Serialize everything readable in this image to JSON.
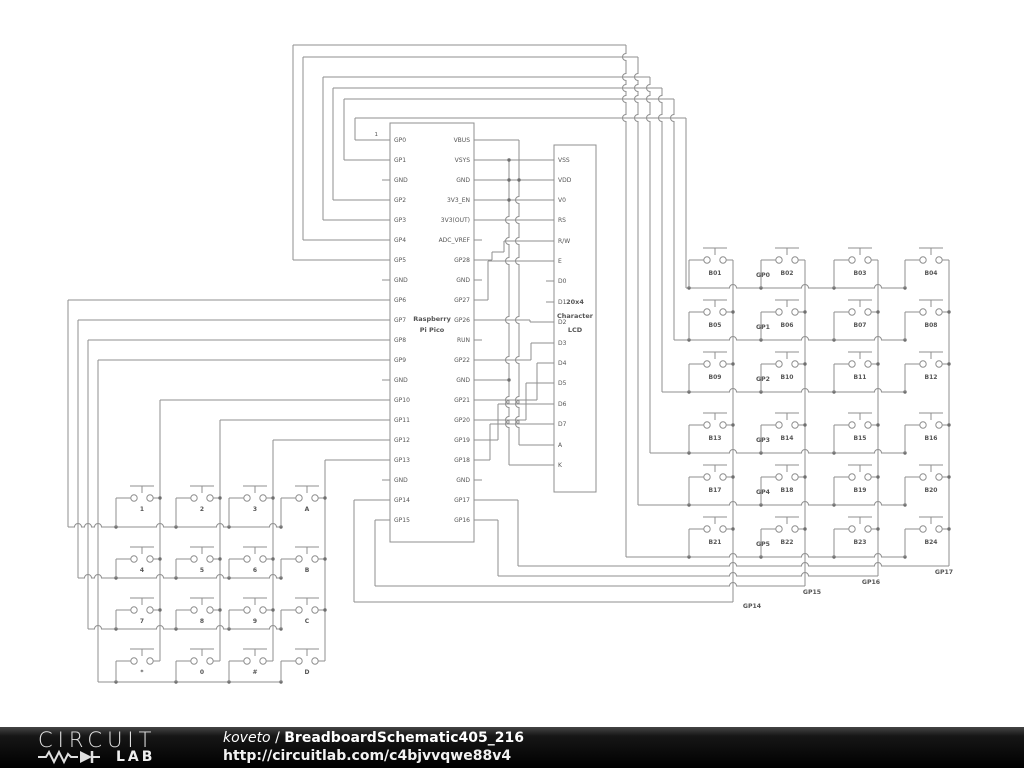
{
  "colors": {
    "wire": "#8f8f8f",
    "text": "#555555",
    "junction": "#6f6f6f",
    "footer_bg": "#0d0d0d",
    "footer_text": "#ffffff"
  },
  "pico": {
    "name_line1": "Raspberry",
    "name_line2": "Pi Pico",
    "pin1_label": "1",
    "left_pins": [
      "GP0",
      "GP1",
      "GND",
      "GP2",
      "GP3",
      "GP4",
      "GP5",
      "GND",
      "GP6",
      "GP7",
      "GP8",
      "GP9",
      "GND",
      "GP10",
      "GP11",
      "GP12",
      "GP13",
      "GND",
      "GP14",
      "GP15"
    ],
    "right_pins": [
      "VBUS",
      "VSYS",
      "GND",
      "3V3_EN",
      "3V3(OUT)",
      "ADC_VREF",
      "GP28",
      "GND",
      "GP27",
      "GP26",
      "RUN",
      "GP22",
      "GND",
      "GP21",
      "GP20",
      "GP19",
      "GP18",
      "GND",
      "GP17",
      "GP16"
    ]
  },
  "lcd": {
    "name_line1": "20x4",
    "name_line2": "Character",
    "name_line3": "LCD",
    "pins": [
      "VSS",
      "VDD",
      "V0",
      "RS",
      "R/W",
      "E",
      "D0",
      "D1",
      "D2",
      "D3",
      "D4",
      "D5",
      "D6",
      "D7",
      "A",
      "K"
    ]
  },
  "keypad": {
    "buttons": [
      [
        "1",
        "2",
        "3",
        "A"
      ],
      [
        "4",
        "5",
        "6",
        "B"
      ],
      [
        "7",
        "8",
        "9",
        "C"
      ],
      [
        "*",
        "0",
        "#",
        "D"
      ]
    ]
  },
  "matrix": {
    "buttons": [
      [
        "B01",
        "B02",
        "B03",
        "B04"
      ],
      [
        "B05",
        "B06",
        "B07",
        "B08"
      ],
      [
        "B09",
        "B10",
        "B11",
        "B12"
      ],
      [
        "B13",
        "B14",
        "B15",
        "B16"
      ],
      [
        "B17",
        "B18",
        "B19",
        "B20"
      ],
      [
        "B21",
        "B22",
        "B23",
        "B24"
      ]
    ],
    "row_labels": [
      "GP0",
      "GP1",
      "GP2",
      "GP3",
      "GP4",
      "GP5"
    ],
    "bottom_labels": [
      "GP14",
      "GP15",
      "GP16",
      "GP17"
    ]
  },
  "footer": {
    "logo_line1": "CIRCUIT",
    "logo_line2": "LAB",
    "author": "koveto",
    "separator": " / ",
    "title": "BreadboardSchematic405_216",
    "url": "http://circuitlab.com/c4bjvvqwe88v4"
  }
}
